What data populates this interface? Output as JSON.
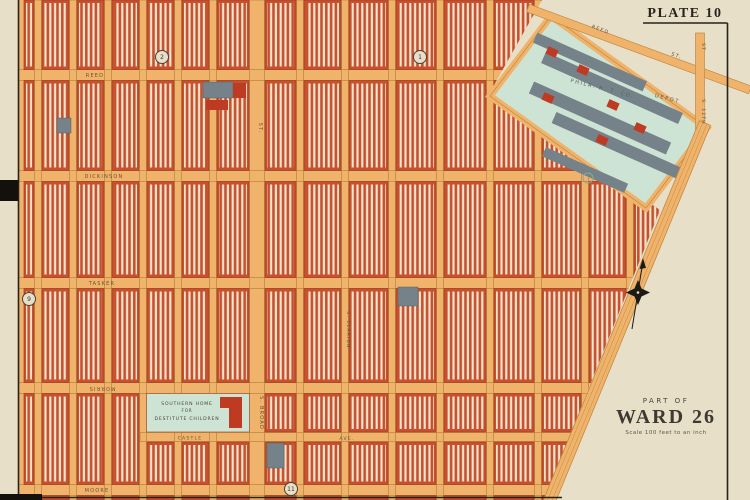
{
  "plate": {
    "title": "PLATE 10"
  },
  "ward": {
    "part_of": "PART OF",
    "name": "WARD 26",
    "scale": "Scale 100 feet to an inch"
  },
  "labels": {
    "streets": {
      "reed": "REED",
      "dickinson": "DICKINSON",
      "tasker": "TASKER",
      "morris": "MORRIS",
      "moore": "MOORE",
      "castle": "CASTLE",
      "castle_suffix": "AVE.",
      "broad_suffix": "ST.",
      "broad": "S. BROAD",
      "clarion": "S. CLARION",
      "twelfth": "S. 12TH",
      "twelfth_suffix": "ST",
      "reed_diag": "REED",
      "reed_diag_suffix": "ST."
    },
    "landmarks": {
      "depot_line1": "PHILA. R. T. CO.",
      "depot_line2": "DEPOT",
      "home_line1": "SOUTHERN HOME",
      "home_line2": "FOR",
      "home_line3": "DESTITUTE CHILDREN"
    },
    "refs": {
      "r1": "1",
      "r2": "2",
      "r9": "9",
      "r11": "11"
    }
  },
  "colors": {
    "paper": "#e8dfc9",
    "street": "#f0b36b",
    "street_edge": "#c08a42",
    "block_red": "#c8502f",
    "block_edge": "#a03d1f",
    "comb_cream": "#f0e4cb",
    "depot_teal": "#cde3d4",
    "building_slate": "#76828a",
    "building_red": "#bf3a22",
    "ink": "#26211b",
    "label_brown": "#6a5336",
    "depot_text": "#51665a",
    "home_text": "#4c4338"
  }
}
